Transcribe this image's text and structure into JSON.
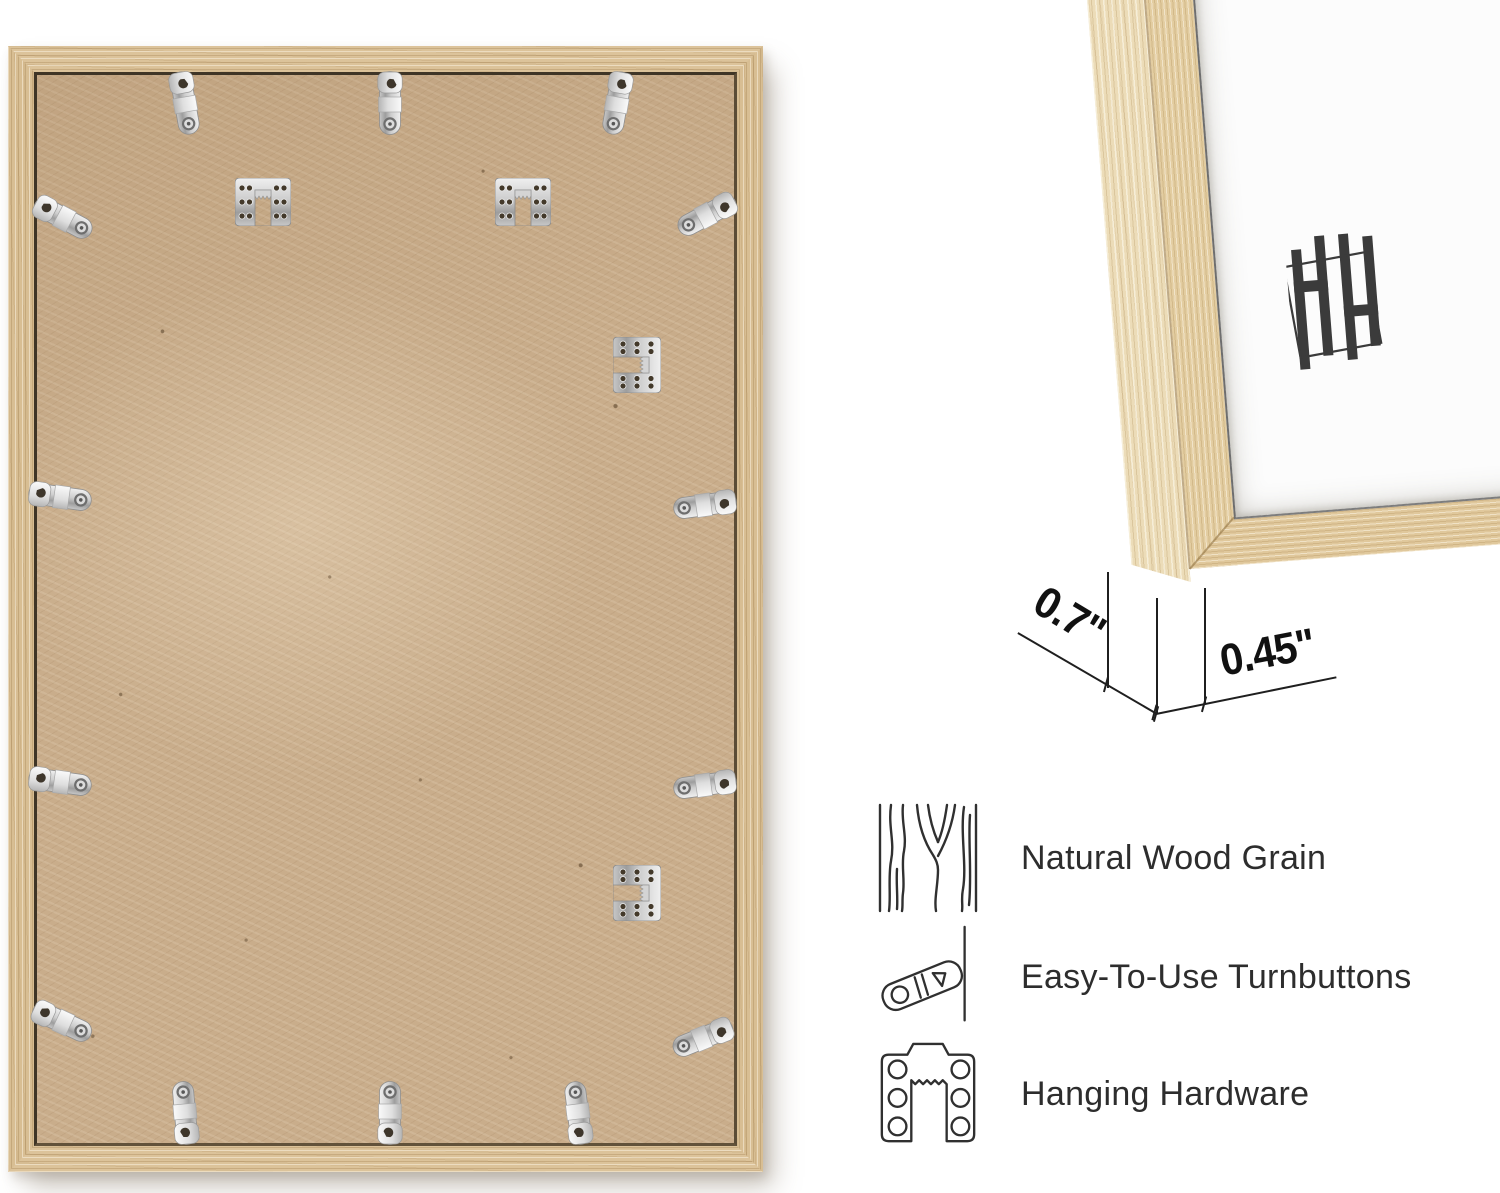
{
  "page": {
    "background_color": "#ffffff",
    "type": "product infographic photo"
  },
  "frame_back": {
    "description": "rear view of natural wood picture frame with MDF backing",
    "wood_color": "#d9c096",
    "backing_color": "#c9ad8b",
    "turnbutton_count": 14,
    "sawtooth_hanger_count": 4
  },
  "corner_detail": {
    "description": "front corner close-up of natural wood frame with white insert",
    "logo": "HH",
    "logo_color": "#3b3b3b",
    "wood_side_color": "#ecdcb8",
    "wood_front_color": "#e3cda1"
  },
  "dimensions": {
    "depth": "0.7\"",
    "face_width": "0.45\""
  },
  "features": [
    {
      "icon": "wood-grain-icon",
      "label": "Natural Wood Grain"
    },
    {
      "icon": "turnbutton-icon",
      "label": "Easy-To-Use Turnbuttons"
    },
    {
      "icon": "hanging-hardware-icon",
      "label": "Hanging Hardware"
    }
  ]
}
